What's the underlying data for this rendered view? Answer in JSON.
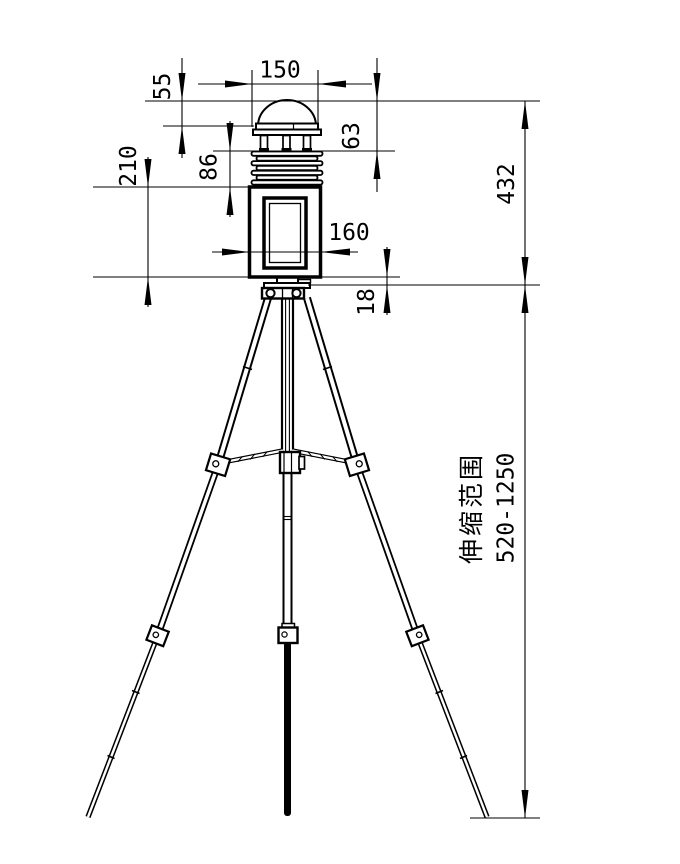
{
  "drawing": {
    "subject": "weather-station-on-telescopic-tripod",
    "background_color": "#ffffff",
    "line_color": "#000000",
    "dimensions": {
      "shield_top_width": "150",
      "dome_height": "55",
      "head_height": "63",
      "louver_stack_height": "86",
      "enclosure_height": "210",
      "enclosure_width": "160",
      "mount_gap": "18",
      "assembly_height": "432"
    },
    "tripod": {
      "range_label": "伸缩范围",
      "range_value": "520-1250"
    }
  }
}
